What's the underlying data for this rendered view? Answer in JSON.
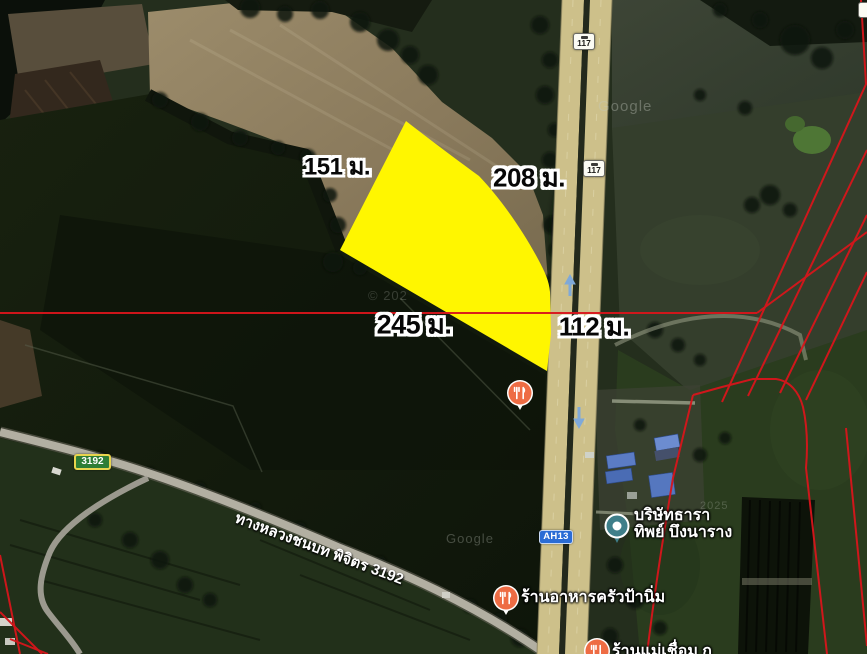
{
  "annotations": {
    "dimensions": [
      {
        "side": "northwest",
        "text": "151 ม."
      },
      {
        "side": "northeast",
        "text": "208 ม."
      },
      {
        "side": "south",
        "text": "245 ม."
      },
      {
        "side": "road-frontage",
        "text": "112 ม."
      }
    ],
    "parcel_fill": "#FFF600",
    "boundary_line_color": "#D8151B"
  },
  "shields": {
    "route_117_top": "117",
    "route_117_mid": "117",
    "asian_highway": "AH13",
    "rural_route": "3192"
  },
  "places": {
    "company": {
      "line1": "บริษัทธารา",
      "line2": "ทิพย์ บึงนาราง"
    },
    "restaurant_main": "ร้านอาหารครัวป้านิ่ม",
    "restaurant_bottom_clipped": "ร้านแม่เชื่อม ก"
  },
  "roads": {
    "rural_road_name": "ทางหลวงชนบท พิจิตร 3192"
  },
  "watermarks": {
    "google_right": "Google",
    "google_bottom": "Google",
    "year_right": "2025",
    "year_center": "© 202"
  },
  "colors": {
    "highway_shield_blue": "#2A6CD5",
    "rural_shield_green": "#2E7D36",
    "restaurant_pin_orange": "#EE6C44",
    "place_pin_teal": "#3F7F8A",
    "lane_arrow_blue": "#7FA9D9"
  }
}
